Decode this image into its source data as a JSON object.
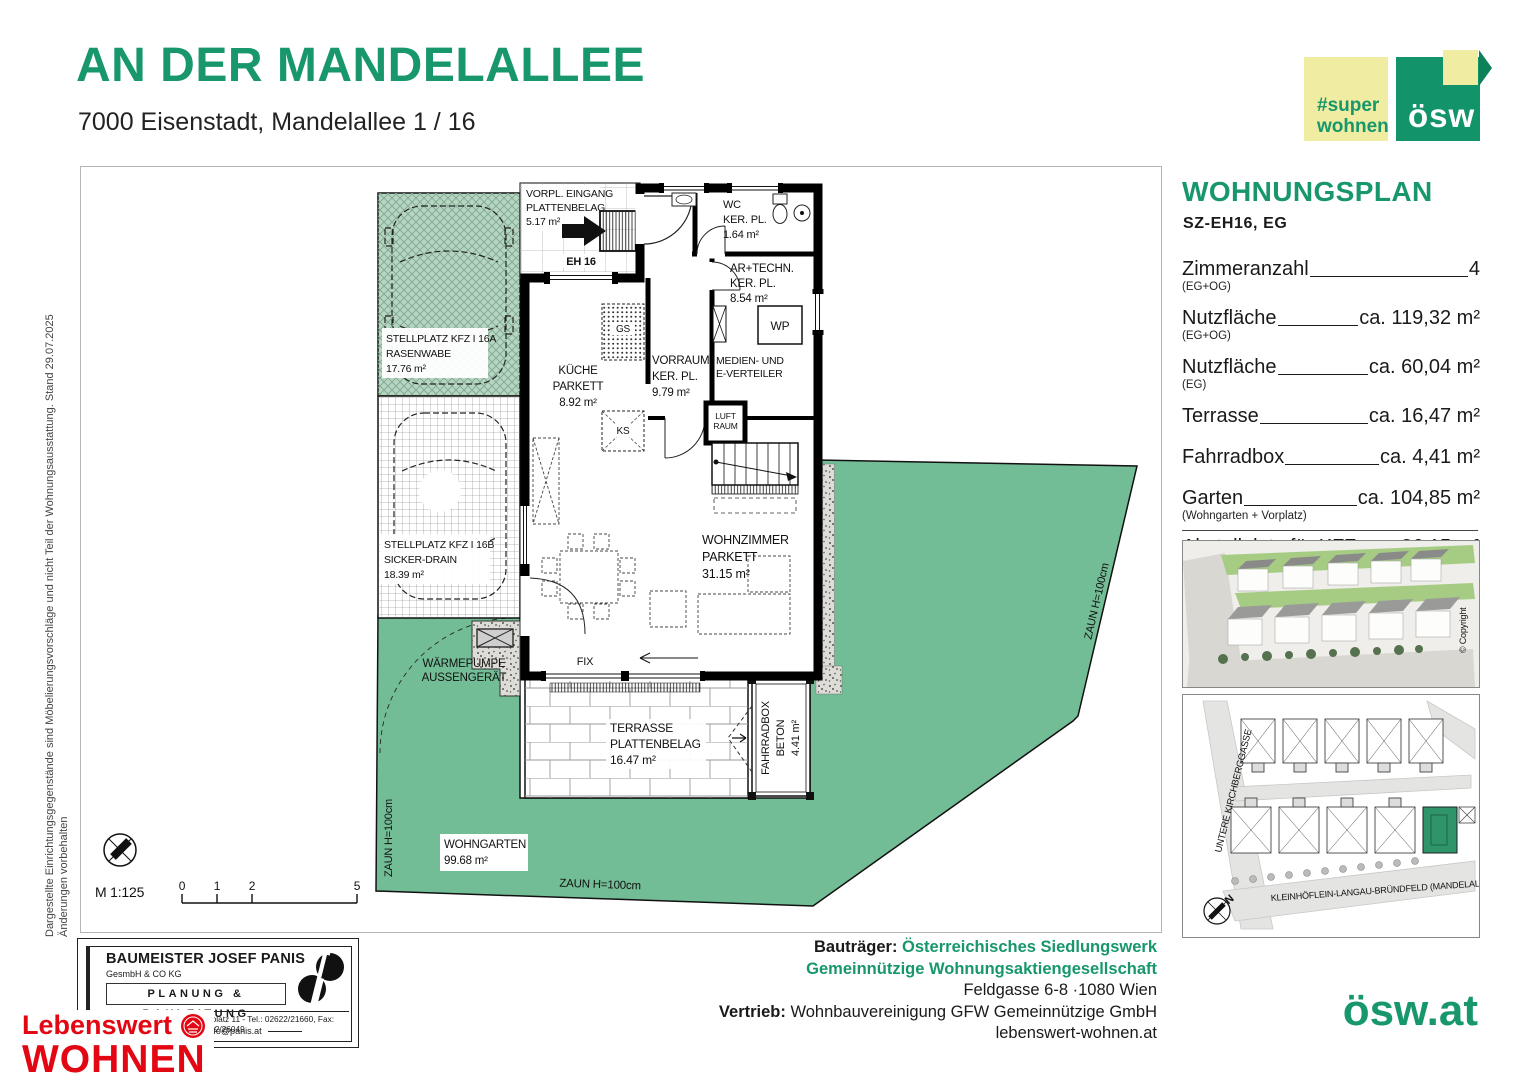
{
  "header": {
    "title": "AN DER MANDELALLEE",
    "subtitle": "7000 Eisenstadt, Mandelallee 1 / 16"
  },
  "logos": {
    "super_line1": "#super",
    "super_line2": "wohnen",
    "oesw": "ösw",
    "oesw_url": "ösw.at"
  },
  "side_note": {
    "line1": "Dargestellte Einrichtungsgegenstände sind Möbelierungsvorschläge und nicht Teil der Wohnungsausstattung. Stand 29.07.2025",
    "line2": "Änderungen vorbehalten"
  },
  "panel": {
    "title": "WOHNUNGSPLAN",
    "subtitle": "SZ-EH16, EG",
    "specs": [
      {
        "label": "Zimmeranzahl",
        "sub": "(EG+OG)",
        "value": "4"
      },
      {
        "label": "Nutzfläche",
        "sub": "(EG+OG)",
        "value": "ca. 119,32 m²"
      },
      {
        "label": "Nutzfläche",
        "sub": "(EG)",
        "value": "ca. 60,04 m²"
      },
      {
        "label": "Terrasse",
        "sub": "",
        "value": "ca. 16,47 m²"
      },
      {
        "label": "Fahrradbox",
        "sub": "",
        "value": "ca. 4,41 m²"
      },
      {
        "label": "Garten",
        "sub": "(Wohngarten + Vorplatz)",
        "value": "ca. 104,85 m²"
      },
      {
        "label": "Abstellplatz für KFZ",
        "sub": "(Stellplatz A + B)",
        "value": "ca. 36,15 m²"
      }
    ],
    "copyright": "© Copyright",
    "siteplan": {
      "street_left": "UNTERE KIRCHBERGGASSE",
      "street_bottom": "KLEINHÖFLEIN-LANGAU-BRÜNDFELD (MANDELALLEE)",
      "north": "N"
    }
  },
  "plan": {
    "scale": "M 1:125",
    "scale_ticks": [
      "0",
      "1",
      "2",
      "5"
    ],
    "stellplatz_a": {
      "l1": "STELLPLATZ KFZ I 16A",
      "l2": "RASENWABE",
      "l3": "17.76 m²"
    },
    "stellplatz_b": {
      "l1": "STELLPLATZ KFZ I 16B",
      "l2": "SICKER-DRAIN",
      "l3": "18.39 m²"
    },
    "vorplatz": {
      "l1": "VORPL. EINGANG",
      "l2": "PLATTENBELAG",
      "l3": "5.17 m²"
    },
    "eh16": "EH 16",
    "wc": {
      "l1": "WC",
      "l2": "KER. PL.",
      "l3": "1.64 m²"
    },
    "artechn": {
      "l1": "AR+TECHN.",
      "l2": "KER. PL.",
      "l3": "8.54 m²"
    },
    "wp": "WP",
    "medien": {
      "l1": "MEDIEN- UND",
      "l2": "E-VERTEILER"
    },
    "kueche": {
      "l1": "KÜCHE",
      "l2": "PARKETT",
      "l3": "8.92 m²"
    },
    "vorraum": {
      "l1": "VORRAUM",
      "l2": "KER. PL.",
      "l3": "9.79 m²"
    },
    "luftraum": {
      "l1": "LUFT",
      "l2": "RAUM"
    },
    "gs": "GS",
    "ks": "KS",
    "wohnzimmer": {
      "l1": "WOHNZIMMER",
      "l2": "PARKETT",
      "l3": "31.15 m²"
    },
    "fix": "FIX",
    "terrasse": {
      "l1": "TERRASSE",
      "l2": "PLATTENBELAG",
      "l3": "16.47 m²"
    },
    "fahrradbox": {
      "l1": "FAHRRADBOX",
      "l2": "BETON",
      "l3": "4.41 m²"
    },
    "waermepumpe": {
      "l1": "WÄRMEPUMPE",
      "l2": "AUSSENGERÄT"
    },
    "wohngarten": {
      "l1": "WOHNGARTEN",
      "l2": "99.68 m²"
    },
    "zaun_left": "ZAUN H=100cm",
    "zaun_bottom": "ZAUN H=100cm",
    "zaun_right": "ZAUN H=100cm"
  },
  "footer": {
    "stamp": {
      "name": "BAUMEISTER JOSEF PANIS",
      "sub": "GesmbH & CO KG",
      "dept": "PLANUNG & BAULEITUNG",
      "address": "2700 Wiener Neustadt, Domplatz 11 - Tel.: 02622/21660, Fax: 02622/26049",
      "email": "e-mail:info@panis.at"
    },
    "lebenswert": {
      "l1": "Lebenswert",
      "l2": "WOHNEN"
    },
    "bautraeger_label": "Bauträger: ",
    "bautraeger_line1": "Österreichisches Siedlungswerk",
    "bautraeger_line2": "Gemeinnützige Wohnungsaktiengesellschaft",
    "address": "Feldgasse 6-8 ·1080 Wien",
    "vertrieb_label": "Vertrieb: ",
    "vertrieb": "Wohnbauvereinigung GFW Gemeinnützige GmbH",
    "website": "lebenswert-wohnen.at"
  },
  "colors": {
    "brand_green": "#17976b",
    "garden_green": "#73bd96",
    "logo_yellow": "#f0eda2",
    "logo_red": "#e30613"
  }
}
